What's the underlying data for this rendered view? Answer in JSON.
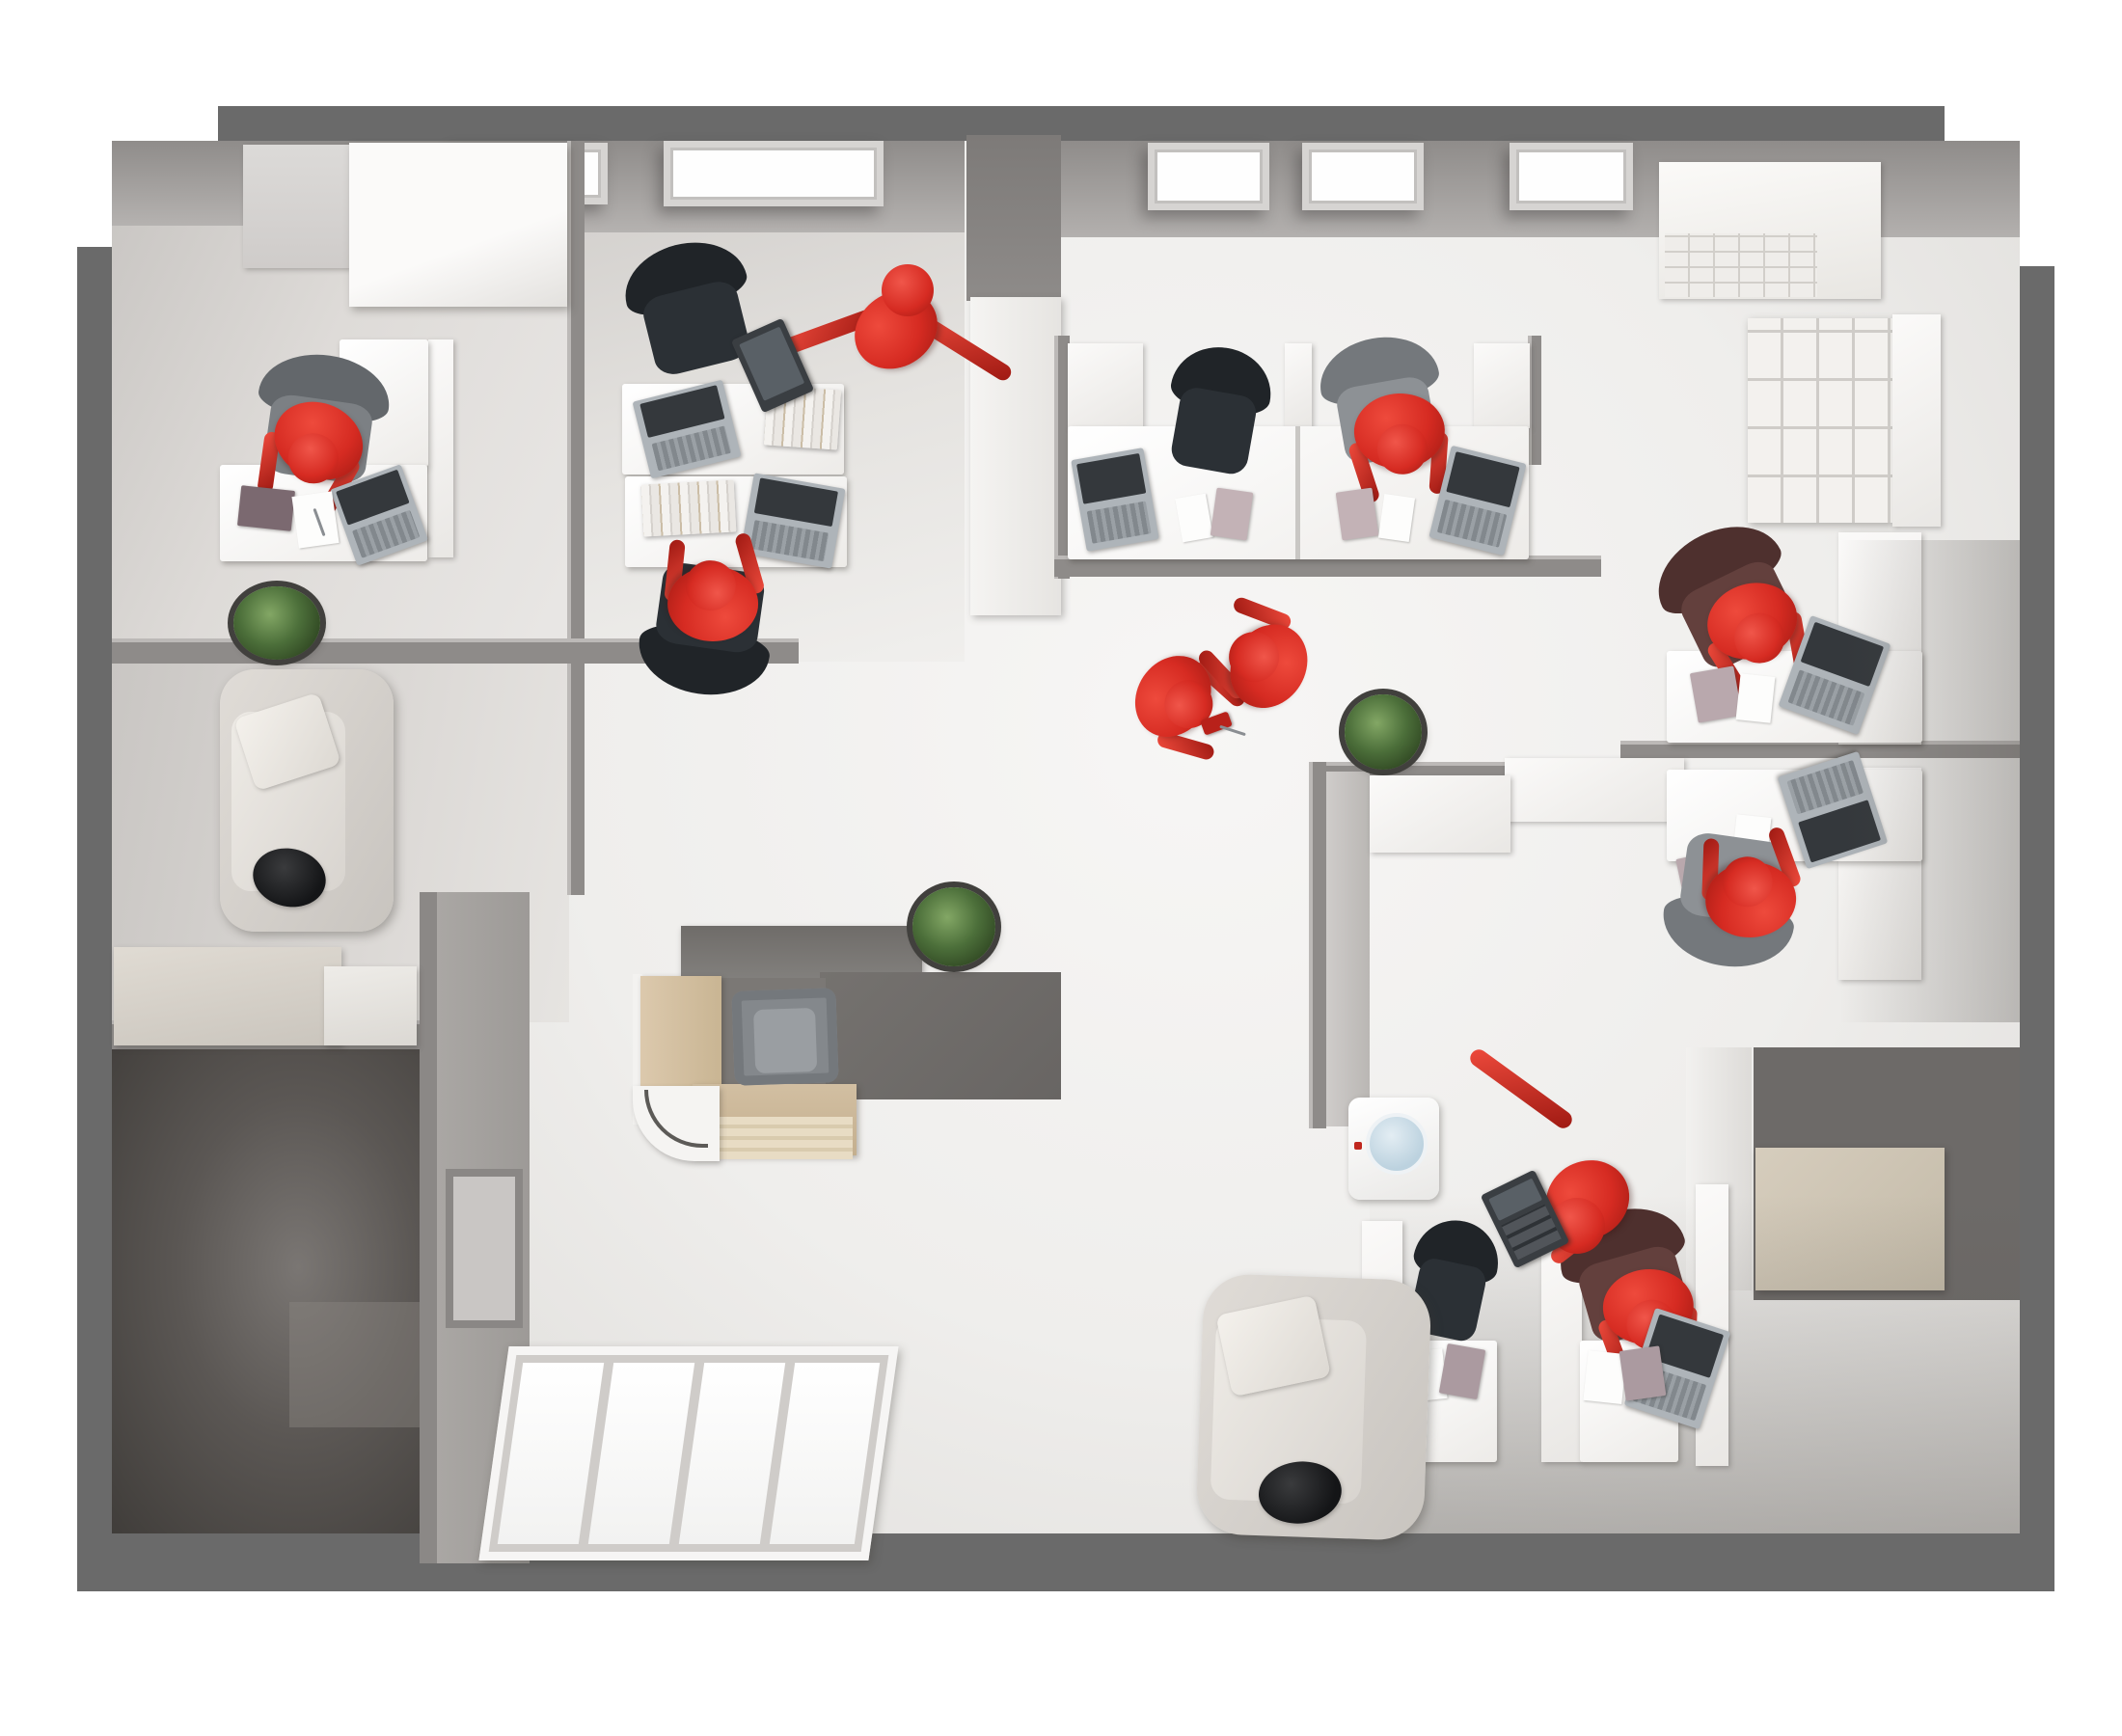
{
  "scene": {
    "type": "3d-top-down-office-floor-plan",
    "people_count": 10,
    "figure_style": "red mannequin figures",
    "background": "#ffffff"
  },
  "palette": {
    "bg": "#ffffff",
    "wall-outer": "#6a6a6a",
    "wall-inner": "#8e8b89",
    "wall-cap": "#bcb9b7",
    "red": "#d62b22",
    "red-hi": "#ee4a3c",
    "red-dk": "#9e1912",
    "laptop-body": "#aeb4b9",
    "laptop-screen": "#34383c"
  },
  "rooms": [
    {
      "id": "private-office",
      "label": "Private office"
    },
    {
      "id": "team-room",
      "label": "Team room"
    },
    {
      "id": "open-office",
      "label": "Open office"
    },
    {
      "id": "lounge",
      "label": "Lounge"
    },
    {
      "id": "storage-room",
      "label": "Storage room"
    },
    {
      "id": "entrance",
      "label": "Entrance"
    },
    {
      "id": "reception",
      "label": "Reception"
    },
    {
      "id": "workstation-bay",
      "label": "Workstation bay"
    },
    {
      "id": "workstation-room",
      "label": "Workstation room"
    }
  ],
  "inventory": {
    "desks": 8,
    "reception_desks": 1,
    "office_chairs": 9,
    "armchairs": 1,
    "sofas": 2,
    "laptops": 9,
    "skylights": 5,
    "plants": 3,
    "bookshelves": 2,
    "storage_cabinets": 6,
    "water_coolers": 1,
    "entrance_doors": 1,
    "tablets": 2,
    "calculators": 1,
    "notebooks": 9,
    "paper_sheets": 7
  },
  "people": [
    {
      "id": "p1",
      "room": "private-office",
      "activity": "sitting at desk working on laptop"
    },
    {
      "id": "p2",
      "room": "team-room",
      "activity": "standing stretching, holding tablet"
    },
    {
      "id": "p3",
      "room": "team-room",
      "activity": "sitting at desk working"
    },
    {
      "id": "p4",
      "room": "open-office",
      "activity": "sitting at desk working"
    },
    {
      "id": "p5",
      "room": "reception",
      "activity": "standing talking with colleague"
    },
    {
      "id": "p6",
      "room": "reception",
      "activity": "standing talking, holding phone"
    },
    {
      "id": "p7",
      "room": "workstation-bay",
      "activity": "sitting at cubicle desk"
    },
    {
      "id": "p8",
      "room": "workstation-bay",
      "activity": "sitting at cubicle desk"
    },
    {
      "id": "p9",
      "room": "workstation-room",
      "activity": "standing pointing, holding calculator"
    },
    {
      "id": "p10",
      "room": "workstation-room",
      "activity": "sitting at desk working"
    }
  ]
}
